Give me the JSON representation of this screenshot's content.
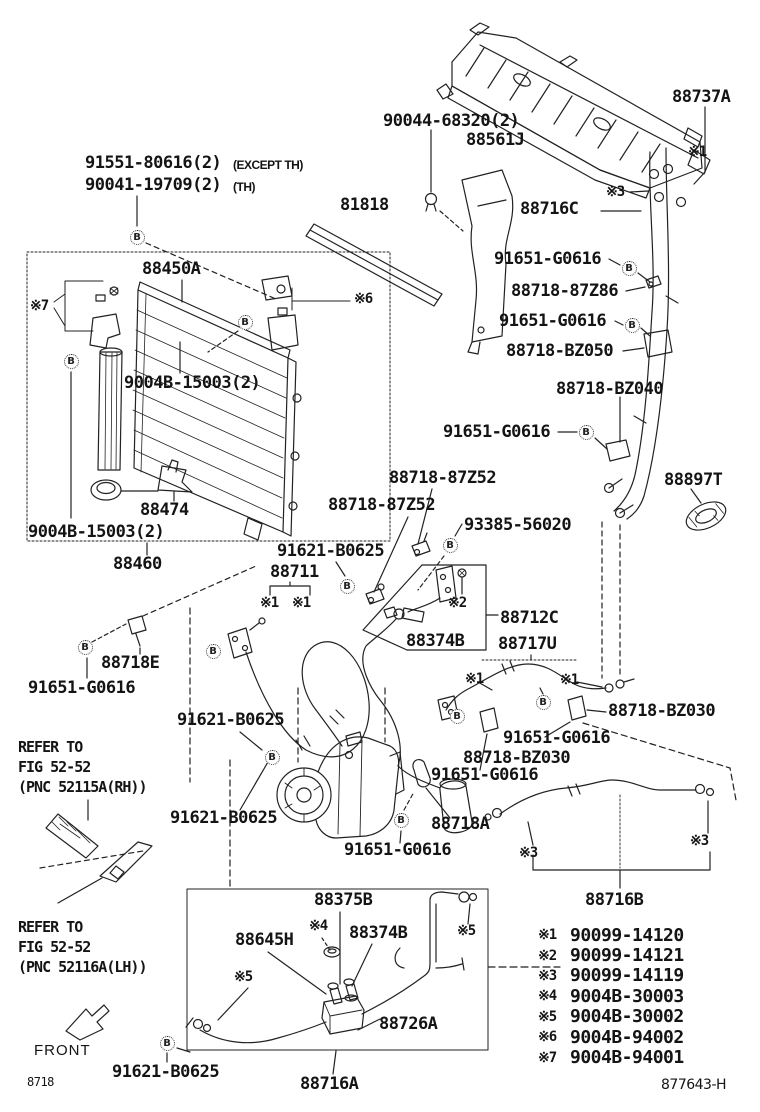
{
  "doc": {
    "figure_code": "8718",
    "drawing_number": "877643-H",
    "front_label": "FRONT"
  },
  "markers": {
    "b_label": "B",
    "positions": [
      [
        137,
        237
      ],
      [
        245,
        322
      ],
      [
        71,
        361
      ],
      [
        629,
        268
      ],
      [
        632,
        325
      ],
      [
        586,
        432
      ],
      [
        450,
        545
      ],
      [
        347,
        586
      ],
      [
        85,
        647
      ],
      [
        213,
        651
      ],
      [
        543,
        702
      ],
      [
        457,
        716
      ],
      [
        272,
        757
      ],
      [
        401,
        820
      ],
      [
        167,
        1043
      ]
    ]
  },
  "labels": [
    {
      "t": "91551-80616(2)",
      "x": 85,
      "y": 155
    },
    {
      "t": "(EXCEPT TH)",
      "x": 233,
      "y": 159,
      "k": "small"
    },
    {
      "t": "90041-19709(2)",
      "x": 85,
      "y": 177
    },
    {
      "t": "(TH)",
      "x": 233,
      "y": 181,
      "k": "small"
    },
    {
      "t": "90044-68320(2)",
      "x": 383,
      "y": 113
    },
    {
      "t": "88561J",
      "x": 466,
      "y": 132
    },
    {
      "t": "88737A",
      "x": 672,
      "y": 89
    },
    {
      "t": "※1",
      "x": 688,
      "y": 145,
      "k": "sym"
    },
    {
      "t": "81818",
      "x": 340,
      "y": 197
    },
    {
      "t": "88716C",
      "x": 520,
      "y": 201
    },
    {
      "t": "※3",
      "x": 606,
      "y": 185,
      "k": "sym"
    },
    {
      "t": "91651-G0616",
      "x": 494,
      "y": 251
    },
    {
      "t": "88718-87Z86",
      "x": 511,
      "y": 283
    },
    {
      "t": "91651-G0616",
      "x": 499,
      "y": 313
    },
    {
      "t": "88718-BZ050",
      "x": 506,
      "y": 343
    },
    {
      "t": "88718-BZ040",
      "x": 556,
      "y": 381
    },
    {
      "t": "91651-G0616",
      "x": 443,
      "y": 424
    },
    {
      "t": "88897T",
      "x": 664,
      "y": 472
    },
    {
      "t": "88450A",
      "x": 142,
      "y": 261
    },
    {
      "t": "※7",
      "x": 30,
      "y": 299,
      "k": "sym"
    },
    {
      "t": "※6",
      "x": 354,
      "y": 292,
      "k": "sym"
    },
    {
      "t": "9004B-15003(2)",
      "x": 124,
      "y": 375
    },
    {
      "t": "88474",
      "x": 140,
      "y": 502
    },
    {
      "t": "9004B-15003(2)",
      "x": 28,
      "y": 524
    },
    {
      "t": "88460",
      "x": 113,
      "y": 556
    },
    {
      "t": "88718-87Z52",
      "x": 389,
      "y": 470
    },
    {
      "t": "88718-87Z52",
      "x": 328,
      "y": 497
    },
    {
      "t": "93385-56020",
      "x": 464,
      "y": 517
    },
    {
      "t": "91621-B0625",
      "x": 277,
      "y": 543
    },
    {
      "t": "88711",
      "x": 270,
      "y": 564
    },
    {
      "t": "※1",
      "x": 260,
      "y": 596,
      "k": "sym"
    },
    {
      "t": "※1",
      "x": 292,
      "y": 596,
      "k": "sym"
    },
    {
      "t": "※2",
      "x": 448,
      "y": 596,
      "k": "sym"
    },
    {
      "t": "88374B",
      "x": 406,
      "y": 633
    },
    {
      "t": "88712C",
      "x": 500,
      "y": 610
    },
    {
      "t": "88717U",
      "x": 498,
      "y": 636
    },
    {
      "t": "※1",
      "x": 465,
      "y": 672,
      "k": "sym"
    },
    {
      "t": "※1",
      "x": 560,
      "y": 673,
      "k": "sym"
    },
    {
      "t": "88718E",
      "x": 101,
      "y": 655
    },
    {
      "t": "91651-G0616",
      "x": 28,
      "y": 680
    },
    {
      "t": "91621-B0625",
      "x": 177,
      "y": 712
    },
    {
      "t": "88718-BZ030",
      "x": 608,
      "y": 703
    },
    {
      "t": "91651-G0616",
      "x": 503,
      "y": 730
    },
    {
      "t": "88718-BZ030",
      "x": 463,
      "y": 750
    },
    {
      "t": "91651-G0616",
      "x": 431,
      "y": 767
    },
    {
      "t": "91621-B0625",
      "x": 170,
      "y": 810
    },
    {
      "t": "88718A",
      "x": 431,
      "y": 816
    },
    {
      "t": "91651-G0616",
      "x": 344,
      "y": 842
    },
    {
      "t": "※3",
      "x": 519,
      "y": 846,
      "k": "sym"
    },
    {
      "t": "※3",
      "x": 690,
      "y": 834,
      "k": "sym"
    },
    {
      "t": "88716B",
      "x": 585,
      "y": 892
    },
    {
      "t": "88375B",
      "x": 314,
      "y": 892
    },
    {
      "t": "※4",
      "x": 309,
      "y": 919,
      "k": "sym"
    },
    {
      "t": "88645H",
      "x": 235,
      "y": 932
    },
    {
      "t": "88374B",
      "x": 349,
      "y": 925
    },
    {
      "t": "※5",
      "x": 457,
      "y": 924,
      "k": "sym"
    },
    {
      "t": "※5",
      "x": 234,
      "y": 970,
      "k": "sym"
    },
    {
      "t": "88726A",
      "x": 379,
      "y": 1016
    },
    {
      "t": "88716A",
      "x": 300,
      "y": 1076
    },
    {
      "t": "91621-B0625",
      "x": 112,
      "y": 1064
    },
    {
      "t": "REFER TO",
      "x": 18,
      "y": 740,
      "k": "refer"
    },
    {
      "t": "FIG 52-52",
      "x": 18,
      "y": 760,
      "k": "refer"
    },
    {
      "t": "(PNC 52115A(RH))",
      "x": 18,
      "y": 780,
      "k": "refer"
    },
    {
      "t": "REFER TO",
      "x": 18,
      "y": 920,
      "k": "refer"
    },
    {
      "t": "FIG 52-52",
      "x": 18,
      "y": 940,
      "k": "refer"
    },
    {
      "t": "(PNC 52116A(LH))",
      "x": 18,
      "y": 960,
      "k": "refer"
    },
    {
      "t": "FRONT",
      "x": 34,
      "y": 1043,
      "k": "front"
    },
    {
      "t": "8718",
      "x": 27,
      "y": 1076,
      "k": "tiny"
    },
    {
      "t": "877643-H",
      "x": 661,
      "y": 1078,
      "k": "code"
    }
  ],
  "legend": {
    "items": [
      {
        "ref": "※1",
        "part": "90099-14120"
      },
      {
        "ref": "※2",
        "part": "90099-14121"
      },
      {
        "ref": "※3",
        "part": "90099-14119"
      },
      {
        "ref": "※4",
        "part": "9004B-30003"
      },
      {
        "ref": "※5",
        "part": "9004B-30002"
      },
      {
        "ref": "※6",
        "part": "9004B-94002"
      },
      {
        "ref": "※7",
        "part": "9004B-94001"
      }
    ]
  }
}
